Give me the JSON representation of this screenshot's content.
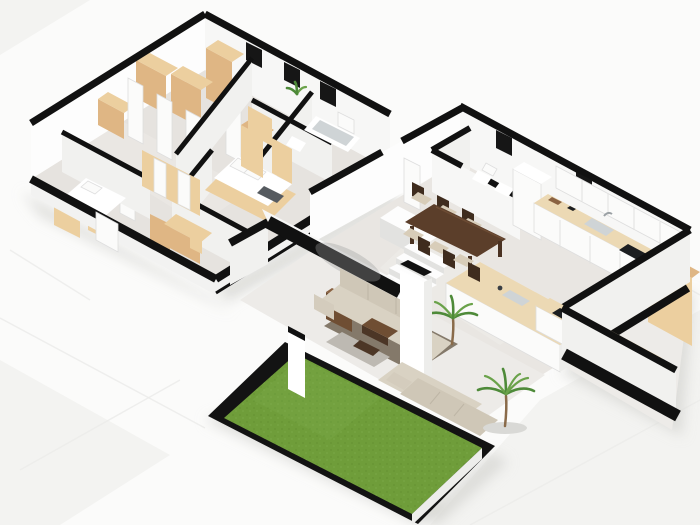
{
  "meta": {
    "title": "3D isometric floor plan render of a two-storey home",
    "image_type": "architectural 3D floor plan visualization",
    "floors_count": 2
  },
  "palette": {
    "background": "#fbfbfa",
    "wall_top": "#111111",
    "wall_face": "#f7f7f6",
    "floor_tile": "#e6e3df",
    "wood_light": "#eccf9f",
    "wood_mid": "#dfb684",
    "counter_wood": "#ecd9b4",
    "table_brown": "#5b3e2a",
    "sofa_beige": "#d9d2c3",
    "rug_gray": "#84796a",
    "lawn_green": "#6f9d3a",
    "lawn_dark": "#5d8a2e",
    "lawn_border": "#131313",
    "plant_green": "#4e8a39",
    "shadow_gray": "#d5d5d2"
  },
  "scene": {
    "upper_floor": {
      "label": "Upper floor - bedrooms and bathroom",
      "rooms": [
        "hallway with closets",
        "bedroom left",
        "bedroom middle",
        "bedroom right",
        "bathroom"
      ],
      "furniture": [
        "wardrobes",
        "sliding-door closet",
        "white bed",
        "double bed",
        "desk and chair",
        "dresser",
        "bathtub",
        "vanity",
        "toilet",
        "radiator",
        "plant"
      ]
    },
    "ground_floor": {
      "label": "Ground floor - open plan living",
      "rooms": [
        "wc",
        "kitchen",
        "dining area",
        "staircase",
        "living room",
        "terrace",
        "garden lawn"
      ],
      "furniture": [
        "kitchen cabinets",
        "counter with sink and cooktop",
        "tall cabinet",
        "island",
        "dining table with six chairs",
        "L-shaped staircase",
        "sectional sofa",
        "second sofa",
        "coffee table",
        "sideboard",
        "fire pit",
        "palm plants",
        "bar peninsula"
      ]
    }
  }
}
